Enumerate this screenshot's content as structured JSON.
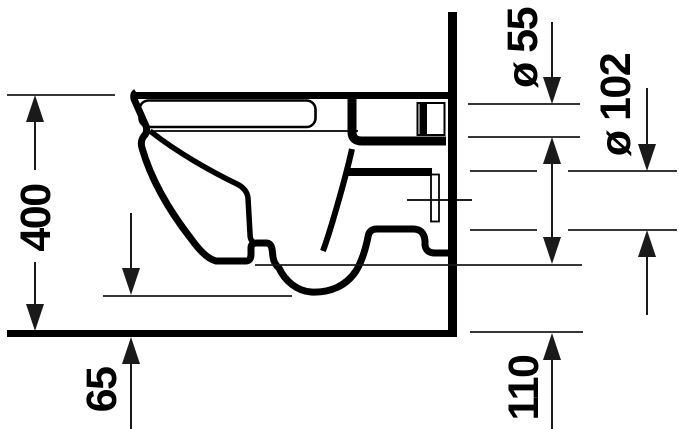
{
  "drawing": {
    "subject": "wall-hung toilet side elevation technical drawing",
    "background_color": "#ffffff",
    "line_color": "#000000",
    "dimensions": {
      "overall_height": "400",
      "floor_gap": "65",
      "flush_connection_diameter": "ø 55",
      "drain_connection_diameter": "ø 102",
      "rear_bottom_height": "110"
    }
  }
}
